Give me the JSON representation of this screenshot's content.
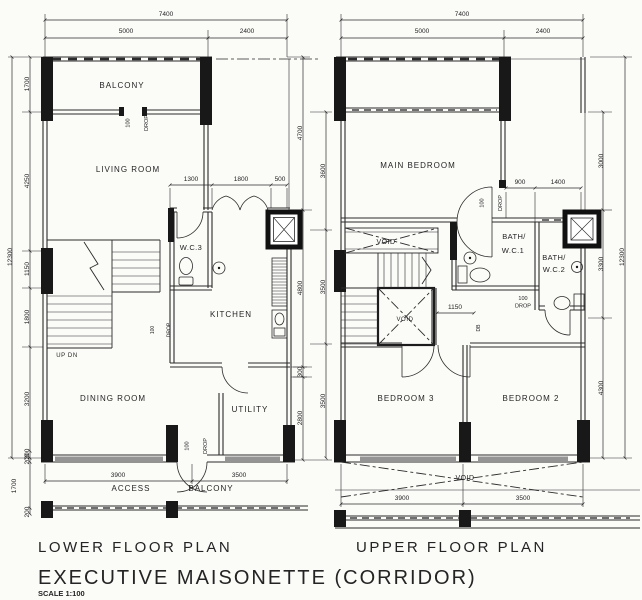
{
  "colors": {
    "line": "#2b2b2b",
    "window_fill": "#949494",
    "paper": "#fbfbf8"
  },
  "titles": {
    "lower": "LOWER FLOOR PLAN",
    "upper": "UPPER FLOOR PLAN",
    "main": "EXECUTIVE MAISONETTE (CORRIDOR)",
    "scale": "SCALE 1:100"
  },
  "shared": {
    "drop_value": "100",
    "drop_word": "DROP",
    "void": "VOID"
  },
  "lower": {
    "rooms": {
      "balcony": "BALCONY",
      "living": "LIVING ROOM",
      "wc3": "W.C.3",
      "kitchen": "KITCHEN",
      "dining": "DINING ROOM",
      "utility": "UTILITY"
    },
    "corridor": {
      "access": "ACCESS",
      "balcony": "BALCONY"
    },
    "stairs": "UP DN",
    "dims": {
      "total_width": "7400",
      "width_left": "5000",
      "width_right": "2400",
      "total_height": "12300",
      "left": [
        "1700",
        "4250",
        "1150",
        "1800",
        "3200",
        "200"
      ],
      "corridor": [
        "200",
        "1700",
        "200"
      ],
      "kitchen": [
        "1300",
        "1800",
        "500"
      ],
      "right_inner": [
        "4700",
        "4800",
        "300",
        "2800"
      ],
      "right_outer": [
        "3600",
        "3500",
        "3500"
      ],
      "bottom": [
        "3900",
        "3500"
      ]
    }
  },
  "upper": {
    "rooms": {
      "main_bedroom": "MAIN BEDROOM",
      "bath1_line1": "BATH/",
      "bath1_line2": "W.C.1",
      "bath2_line1": "BATH/",
      "bath2_line2": "W.C.2",
      "bedroom3": "BEDROOM 3",
      "bedroom2": "BEDROOM 2"
    },
    "db": "DB",
    "dims": {
      "total_width": "7400",
      "width_left": "5000",
      "width_right": "2400",
      "total_height": "12300",
      "right": [
        "3000",
        "3300",
        "4300"
      ],
      "bath": [
        "900",
        "1400"
      ],
      "landing": "1150",
      "bottom": [
        "3900",
        "3500"
      ]
    }
  }
}
